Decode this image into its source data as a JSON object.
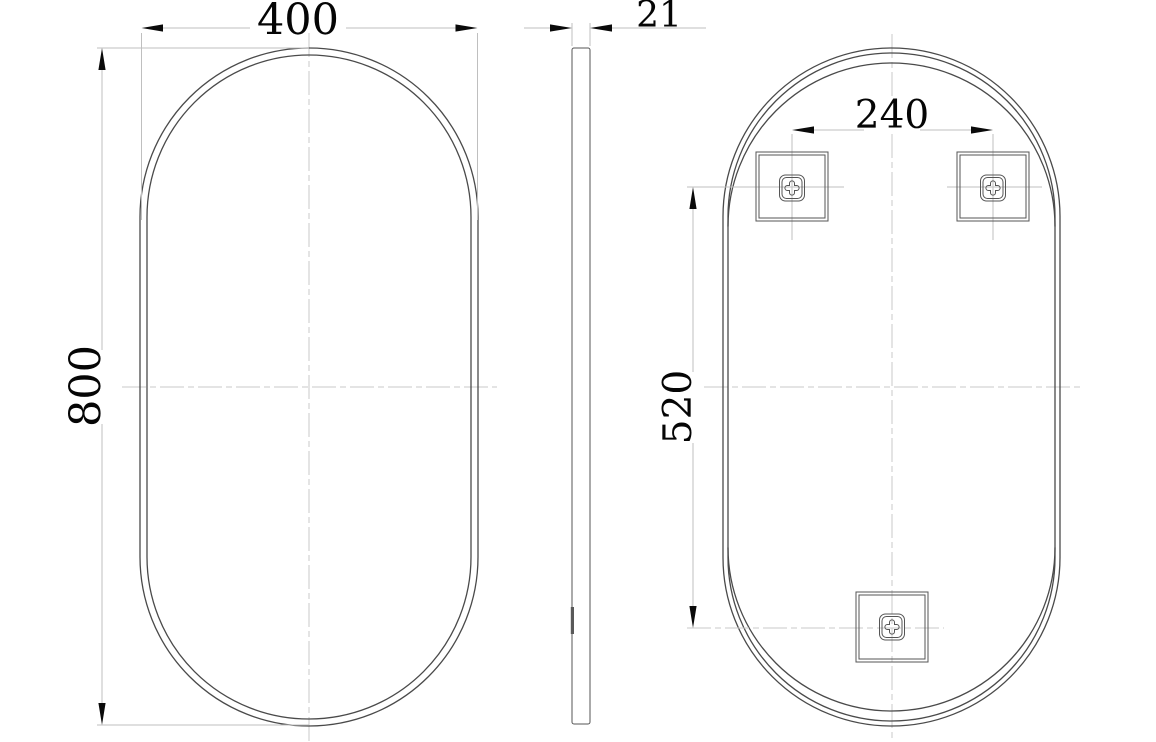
{
  "drawing": {
    "type": "technical-drawing-oval-mirror",
    "dimensions": {
      "front_width": "400",
      "front_height": "800",
      "side_thickness": "21",
      "back_bracket_spacing_h": "240",
      "back_bracket_spacing_v": "520"
    },
    "colors": {
      "background": "#ffffff",
      "outline": "#4a4a4a",
      "dimension_lines": "#bfbfbf",
      "centerlines": "#c8c8c8",
      "dimension_text": "#050505"
    }
  }
}
